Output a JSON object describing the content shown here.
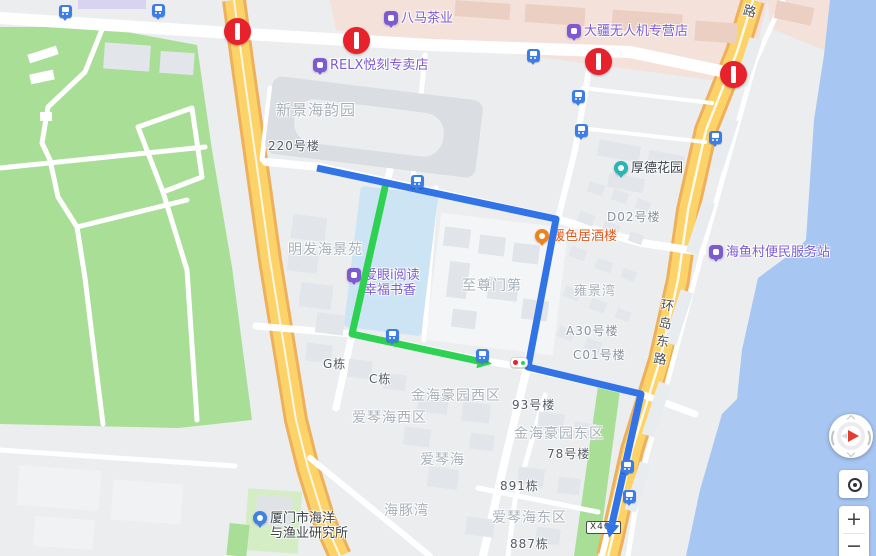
{
  "map": {
    "pois": [
      {
        "label": "八马茶业",
        "x": 384,
        "y": 11,
        "icon": "shop-pin-icon",
        "theme": "purple",
        "icon_color": "#7e5ad2"
      },
      {
        "label": "大疆无人机专营店",
        "x": 567,
        "y": 24,
        "icon": "shop-pin-icon",
        "theme": "purple",
        "icon_color": "#7e5ad2"
      },
      {
        "label": "RELX悦刻专卖店",
        "x": 313,
        "y": 58,
        "icon": "shop-pin-icon",
        "theme": "purple",
        "icon_color": "#7e5ad2"
      },
      {
        "label": "厚德花园",
        "x": 614,
        "y": 161,
        "icon": "garden-pin-icon",
        "theme": "dark",
        "icon_color": "#2ab5b5",
        "round": true
      },
      {
        "label": "暖色居酒楼",
        "x": 535,
        "y": 229,
        "icon": "restaurant-pin-icon",
        "theme": "orange",
        "icon_color": "#f0821d",
        "round": true
      },
      {
        "label": "爱眼i阅读",
        "label2": "幸福书香",
        "x": 347,
        "y": 268,
        "icon": "shop-pin-icon",
        "theme": "purple",
        "icon_color": "#7e5ad2"
      },
      {
        "label": "海鱼村便民服务站",
        "x": 709,
        "y": 245,
        "icon": "shop-pin-icon",
        "theme": "purple",
        "icon_color": "#7e5ad2"
      },
      {
        "label": "厦门市海洋",
        "label2": "与渔业研究所",
        "x": 253,
        "y": 511,
        "icon": "gov-pin-icon",
        "theme": "dark",
        "icon_color": "#3f83e0",
        "round": true
      }
    ],
    "area_labels": [
      {
        "text": "新景海韵园",
        "x": 276,
        "y": 99,
        "cls": "estate",
        "size": 15
      },
      {
        "text": "220号楼",
        "x": 268,
        "y": 137,
        "cls": "bldg",
        "size": 12
      },
      {
        "text": "D02号楼",
        "x": 607,
        "y": 208,
        "cls": "mid",
        "size": 12
      },
      {
        "text": "明发海景苑",
        "x": 288,
        "y": 239,
        "cls": "estate",
        "size": 14
      },
      {
        "text": "至尊门第",
        "x": 462,
        "y": 275,
        "cls": "estate",
        "size": 14
      },
      {
        "text": "雍景湾",
        "x": 574,
        "y": 280,
        "cls": "estate",
        "size": 13
      },
      {
        "text": "A30号楼",
        "x": 566,
        "y": 322,
        "cls": "mid",
        "size": 12
      },
      {
        "text": "C01号楼",
        "x": 573,
        "y": 346,
        "cls": "mid",
        "size": 12
      },
      {
        "text": "G栋",
        "x": 323,
        "y": 355,
        "cls": "bldg",
        "size": 12
      },
      {
        "text": "C栋",
        "x": 369,
        "y": 370,
        "cls": "bldg",
        "size": 12
      },
      {
        "text": "金海豪园西区",
        "x": 411,
        "y": 385,
        "cls": "estate",
        "size": 14
      },
      {
        "text": "93号楼",
        "x": 512,
        "y": 396,
        "cls": "bldg",
        "size": 12
      },
      {
        "text": "爱琴海西区",
        "x": 352,
        "y": 407,
        "cls": "estate",
        "size": 14
      },
      {
        "text": "金海豪园东区",
        "x": 514,
        "y": 423,
        "cls": "estate",
        "size": 14
      },
      {
        "text": "爱琴海",
        "x": 420,
        "y": 449,
        "cls": "estate",
        "size": 14
      },
      {
        "text": "78号楼",
        "x": 547,
        "y": 445,
        "cls": "bldg",
        "size": 12
      },
      {
        "text": "891栋",
        "x": 500,
        "y": 477,
        "cls": "bldg",
        "size": 12
      },
      {
        "text": "海豚湾",
        "x": 384,
        "y": 500,
        "cls": "estate",
        "size": 14
      },
      {
        "text": "爱琴海东区",
        "x": 492,
        "y": 507,
        "cls": "estate",
        "size": 14
      },
      {
        "text": "887栋",
        "x": 510,
        "y": 535,
        "cls": "bldg",
        "size": 12
      }
    ],
    "road_labels": [
      {
        "text": "环岛东路",
        "x": 652,
        "y": 298,
        "rotate": 8
      },
      {
        "text": "东路",
        "x": 740,
        "y": -14,
        "rotate": 15
      }
    ],
    "road_shield": {
      "text": "X401",
      "x": 586,
      "y": 521
    },
    "bus_stops": [
      [
        65,
        11
      ],
      [
        158,
        10
      ],
      [
        533,
        55
      ],
      [
        578,
        96
      ],
      [
        581,
        130
      ],
      [
        715,
        137
      ],
      [
        417,
        181
      ],
      [
        392,
        335
      ],
      [
        482,
        355
      ],
      [
        627,
        466
      ],
      [
        629,
        496
      ]
    ],
    "no_entry_signs": [
      [
        237,
        31
      ],
      [
        356,
        40
      ],
      [
        598,
        61
      ],
      [
        733,
        74
      ]
    ],
    "traffic_light": {
      "x": 510,
      "y": 357
    },
    "routes": {
      "blue": {
        "name": "route-blue",
        "color": "#3274e5",
        "width": 7,
        "points": [
          [
            317,
            168
          ],
          [
            556,
            219
          ],
          [
            528,
            367
          ],
          [
            641,
            394
          ],
          [
            612,
            524
          ]
        ]
      },
      "green": {
        "name": "route-green",
        "color": "#2fd153",
        "width": 7,
        "points": [
          [
            386,
            183
          ],
          [
            352,
            334
          ],
          [
            478,
            361
          ]
        ]
      }
    },
    "controls": {
      "zoom_in_label": "+",
      "zoom_out_label": "−"
    },
    "palette": {
      "land": "#ebedef",
      "water": "#a7c6f1",
      "park": "#a9de97",
      "arterial_road": "#fbd369",
      "route_blue": "#3274e5",
      "route_green": "#2fd153"
    }
  }
}
